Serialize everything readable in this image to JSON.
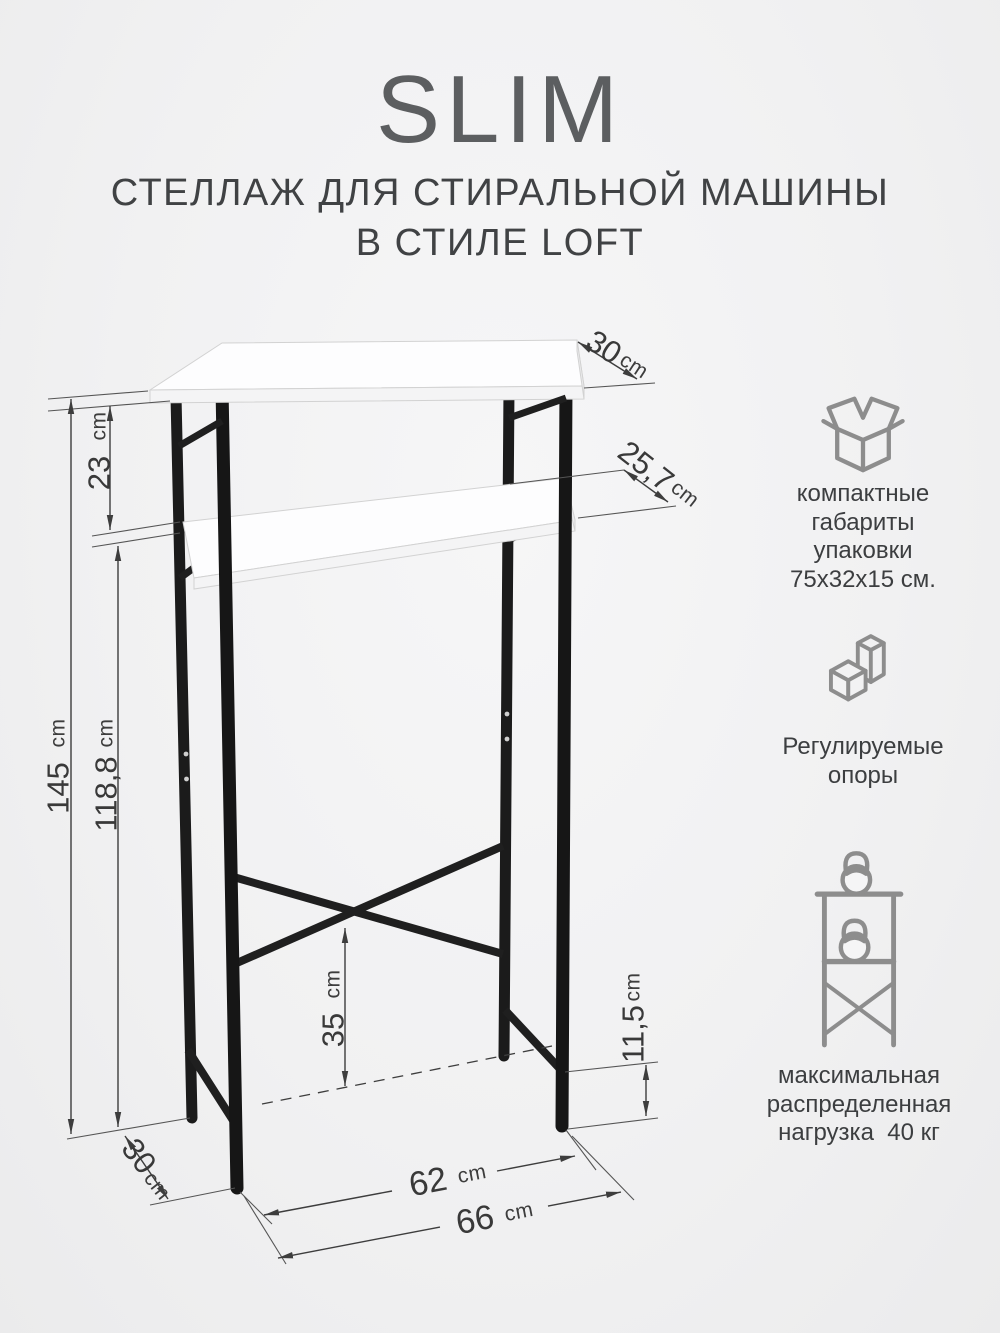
{
  "header": {
    "title": "SLIM",
    "subtitle_line1": "СТЕЛЛАЖ ДЛЯ СТИРАЛЬНОЙ МАШИНЫ",
    "subtitle_line2": "В СТИЛЕ LOFT"
  },
  "product": "стеллаж для стиральной машины",
  "dimensions": {
    "top_depth": {
      "v": "30",
      "u": "cm"
    },
    "upper_gap": {
      "v": "23",
      "u": "cm"
    },
    "shelf_depth": {
      "v": "25,7",
      "u": "cm"
    },
    "total_height": {
      "v": "145",
      "u": "cm"
    },
    "clearance_height": {
      "v": "118,8",
      "u": "cm"
    },
    "brace_height": {
      "v": "35",
      "u": "cm"
    },
    "rail_height": {
      "v": "11,5",
      "u": "cm"
    },
    "inner_width": {
      "v": "62",
      "u": "cm"
    },
    "outer_width": {
      "v": "66",
      "u": "cm"
    },
    "bottom_depth": {
      "v": "30",
      "u": "cm"
    }
  },
  "features": [
    {
      "icon": "package-box-icon",
      "lines": [
        "компактные",
        "габариты",
        "упаковки",
        "75х32х15 см."
      ]
    },
    {
      "icon": "adjustable-feet-icon",
      "lines": [
        "Регулируемые",
        "опоры"
      ]
    },
    {
      "icon": "max-load-icon",
      "lines": [
        "максимальная",
        "распределенная",
        "нагрузка  40 кг"
      ]
    }
  ],
  "colors": {
    "frame": "#1b1b1b",
    "board": "#fdfdfe",
    "dimension_lines": "#3d3d3d",
    "icon_stroke": "#8d8d8d",
    "text": "#3c3e40",
    "background": "#f2f2f3"
  }
}
